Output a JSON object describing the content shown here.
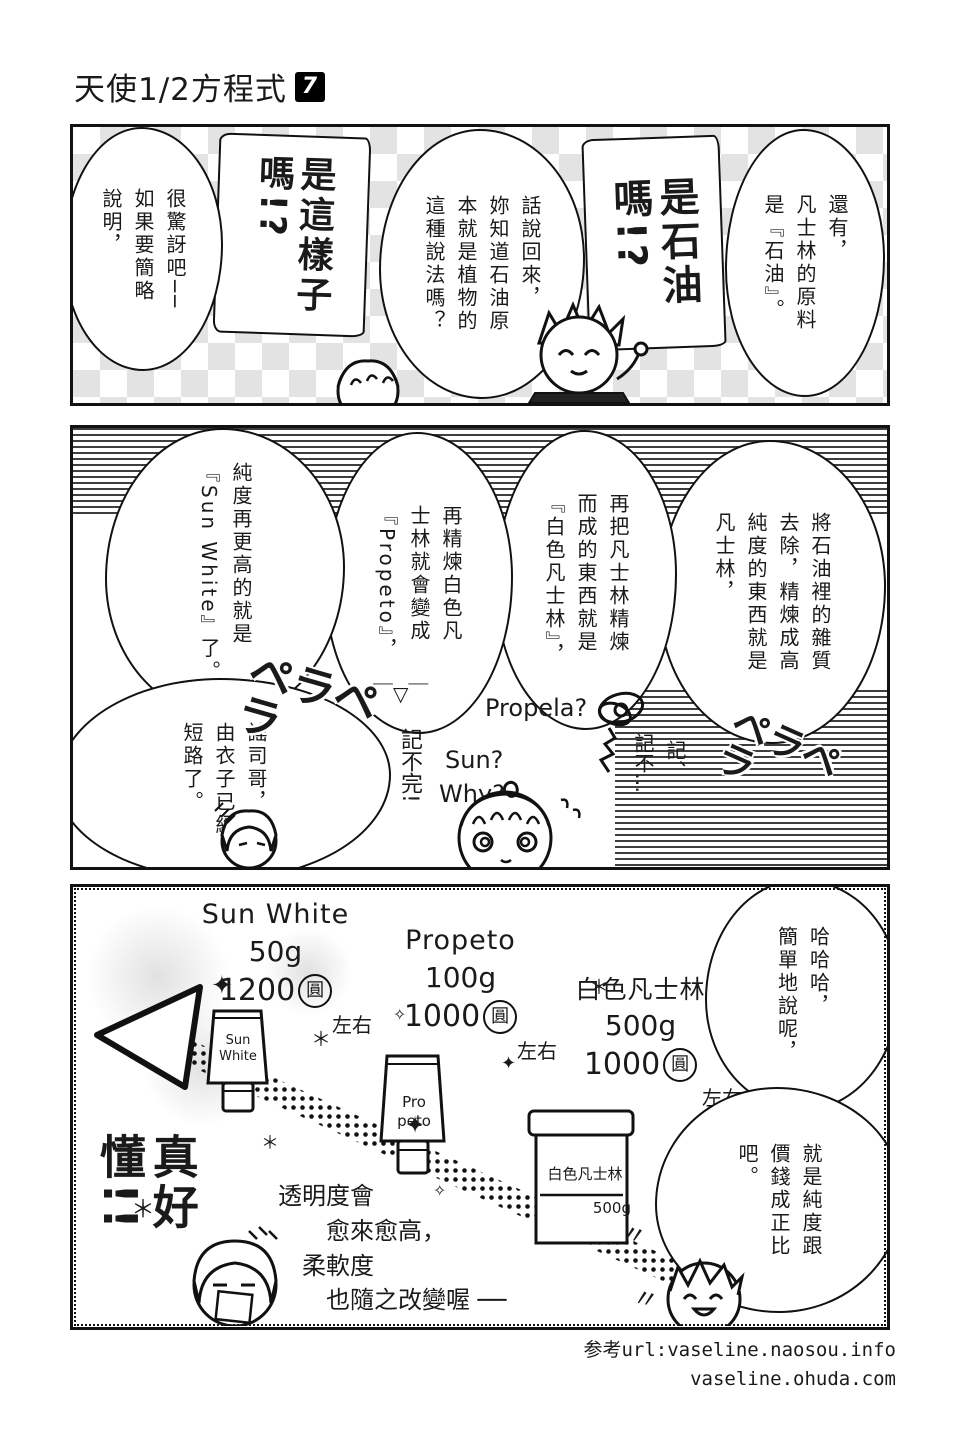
{
  "page": {
    "title": "天使1/2方程式",
    "volume_badge": "7",
    "credits_line1": "参考url:vaseline.naosou.info",
    "credits_line2": "vaseline.ohuda.com"
  },
  "panel1": {
    "bubble_origin": "還有，\n凡士林的原料\n是『石油』。",
    "shout_is_petroleum": "是石油\n嗎!?",
    "bubble_by_the_way": "話說回來，\n妳知道石油原\n本就是植物的\n這種說法嗎？",
    "shout_is_that_so": "是這樣子\n嗎!?",
    "bubble_surprised": "很驚訝吧──\n如果要簡略\n說明，"
  },
  "panel2": {
    "bubble_refine1": "將石油裡的雜質\n去除，精煉成高\n純度的東西就是\n凡士林，",
    "bubble_refine2": "再把凡士林精煉\n而成的東西就是\n『白色凡士林』，",
    "bubble_refine3": "再精煉白色凡\n士林就會變成\n『Propeto』，",
    "face_emoticon": "￣▽￣",
    "bubble_refine4": "純度再更高的就是\n『Sun White』了。",
    "bubble_short_circuit": "謠司哥，\n由衣子已經\n短路了。",
    "sfx_pera_1": "ペラペラ",
    "sfx_pera_2": "ペラペラ",
    "hw_cant_remember": "記不完!",
    "hw_sun": "Sun?",
    "hw_why": "Why?",
    "hw_propela": "Propela?",
    "hw_ki_1": "記不…",
    "hw_ki_2": "記、"
  },
  "panel3": {
    "bubble_hahaha": "哈哈哈，\n簡單地說呢，",
    "bubble_price": "就是純度跟\n價錢成正比\n吧。",
    "products": [
      {
        "name": "Sun White",
        "weight": "50g",
        "price": "1200",
        "unit": "圓",
        "approx": "左右",
        "label": "Sun\nWhite"
      },
      {
        "name": "Propeto",
        "weight": "100g",
        "price": "1000",
        "unit": "圓",
        "approx": "左右",
        "label": "Pro\npeto"
      },
      {
        "name": "白色凡士林",
        "weight": "500g",
        "price": "1000",
        "unit": "圓",
        "approx": "左右",
        "label": "白色凡士林",
        "label2": "500g"
      }
    ],
    "shout_easy": "真好懂!!",
    "hw_transparency": "透明度會\n　　愈來愈高，\n　柔軟度\n　　也隨之改變喔 ──",
    "quote_mark": "〃",
    "sparkles": [
      "✦",
      "＊",
      "✧",
      "✦",
      "＊",
      "＊",
      "✧",
      "＊",
      "✦"
    ]
  }
}
